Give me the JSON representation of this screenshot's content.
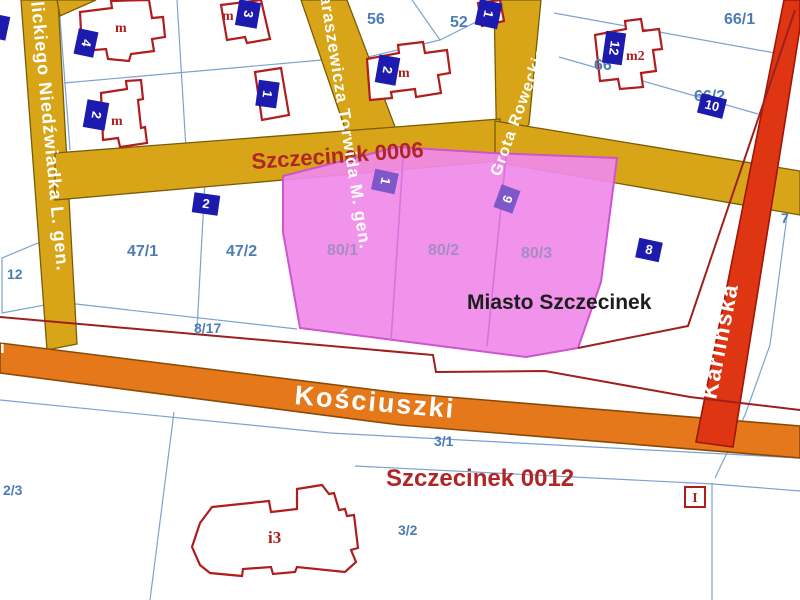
{
  "colors": {
    "street_yellow": "#d7a517",
    "street_orange": "#e4781a",
    "street_red": "#de3512",
    "selection_pink": "#f08ae9",
    "selection_border": "#cf54cf",
    "parcel_line": "#7ca3cd",
    "boundary_red": "#9e1f1f",
    "building_red": "#b01d1d",
    "badge_navy": "#1d1bae",
    "badge_purple": "#7e57c9",
    "label_blue": "#4d7db5",
    "label_red": "#b02626",
    "label_black": "#1d1d1d",
    "label_pink_parcel": "#a58cc2",
    "street_text": "#ffffff"
  },
  "regions": {
    "district_top": "Szczecinek 0006",
    "district_bottom": "Szczecinek 0012",
    "city": "Miasto Szczecinek"
  },
  "streets": {
    "left": "ulickiego Niedźwiadka L. gen.",
    "karaszewicza": "araszewicza Torwida M. gen.",
    "grota": "Grota Roweckiego",
    "koscuszki": "Kościuszki",
    "karlinska": "Karlińska",
    "left_stub": "i"
  },
  "parcels": {
    "p56": "56",
    "p52": "52",
    "p66_1": "66/1",
    "p66": "66",
    "p66_2": "66/2",
    "p7": "7",
    "p47_1": "47/1",
    "p47_2": "47/2",
    "p80_1": "80/1",
    "p80_2": "80/2",
    "p80_3": "80/3",
    "p12": "12",
    "p8_17": "8/17",
    "p2_3": "2/3",
    "p3_1": "3/1",
    "p3_2": "3/2"
  },
  "badges": {
    "tl_a": "4",
    "tl_b": "3",
    "tl_c": "2",
    "tl_d": "1",
    "on56": "2",
    "on52": "1",
    "on66": "12",
    "on66_2": "10",
    "near47": "2",
    "on80_1": "1",
    "on80_3": "9",
    "on8": "8",
    "info": "I"
  },
  "building_marks": {
    "a": "m",
    "b": "m",
    "c": "m",
    "e": "m",
    "g": "m2",
    "i3": "i3"
  }
}
